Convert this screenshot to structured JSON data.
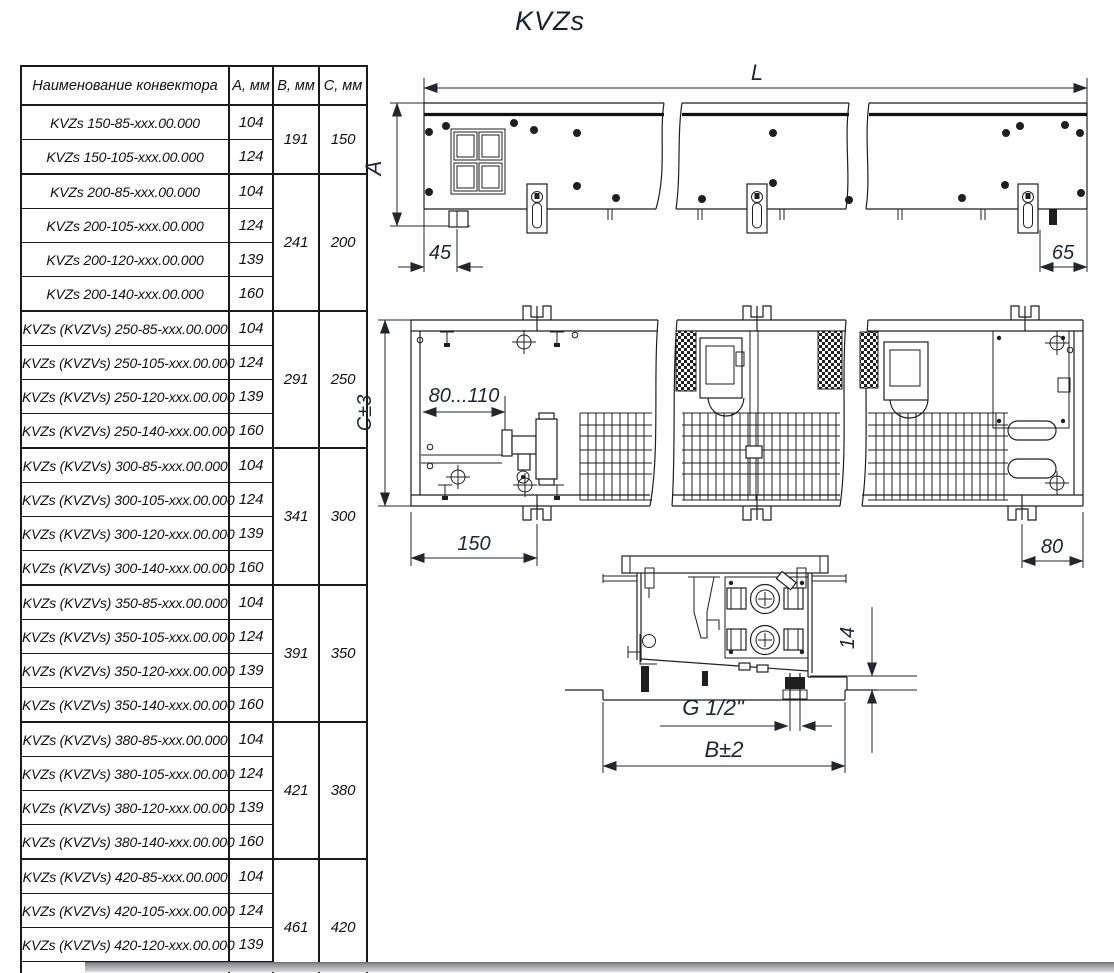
{
  "title": "KVZs",
  "table": {
    "headers": [
      "Наименование конвектора",
      "А, мм",
      "В, мм",
      "С, мм"
    ],
    "groups": [
      {
        "b": "191",
        "c": "150",
        "rows": [
          [
            "KVZs 150-85-xxx.00.000",
            "104"
          ],
          [
            "KVZs 150-105-xxx.00.000",
            "124"
          ]
        ]
      },
      {
        "b": "241",
        "c": "200",
        "rows": [
          [
            "KVZs 200-85-xxx.00.000",
            "104"
          ],
          [
            "KVZs 200-105-xxx.00.000",
            "124"
          ],
          [
            "KVZs 200-120-xxx.00.000",
            "139"
          ],
          [
            "KVZs 200-140-xxx.00.000",
            "160"
          ]
        ]
      },
      {
        "b": "291",
        "c": "250",
        "rows": [
          [
            "KVZs (KVZVs) 250-85-xxx.00.000",
            "104"
          ],
          [
            "KVZs (KVZVs) 250-105-xxx.00.000",
            "124"
          ],
          [
            "KVZs (KVZVs) 250-120-xxx.00.000",
            "139"
          ],
          [
            "KVZs (KVZVs) 250-140-xxx.00.000",
            "160"
          ]
        ]
      },
      {
        "b": "341",
        "c": "300",
        "rows": [
          [
            "KVZs (KVZVs) 300-85-xxx.00.000",
            "104"
          ],
          [
            "KVZs (KVZVs) 300-105-xxx.00.000",
            "124"
          ],
          [
            "KVZs (KVZVs) 300-120-xxx.00.000",
            "139"
          ],
          [
            "KVZs (KVZVs) 300-140-xxx.00.000",
            "160"
          ]
        ]
      },
      {
        "b": "391",
        "c": "350",
        "rows": [
          [
            "KVZs (KVZVs) 350-85-xxx.00.000",
            "104"
          ],
          [
            "KVZs (KVZVs) 350-105-xxx.00.000",
            "124"
          ],
          [
            "KVZs (KVZVs) 350-120-xxx.00.000",
            "139"
          ],
          [
            "KVZs (KVZVs) 350-140-xxx.00.000",
            "160"
          ]
        ]
      },
      {
        "b": "421",
        "c": "380",
        "rows": [
          [
            "KVZs (KVZVs) 380-85-xxx.00.000",
            "104"
          ],
          [
            "KVZs (KVZVs) 380-105-xxx.00.000",
            "124"
          ],
          [
            "KVZs (KVZVs) 380-120-xxx.00.000",
            "139"
          ],
          [
            "KVZs (KVZVs) 380-140-xxx.00.000",
            "160"
          ]
        ]
      },
      {
        "b": "461",
        "c": "420",
        "rows": [
          [
            "KVZs (KVZVs) 420-85-xxx.00.000",
            "104"
          ],
          [
            "KVZs (KVZVs) 420-105-xxx.00.000",
            "124"
          ],
          [
            "KVZs (KVZVs) 420-120-xxx.00.000",
            "139"
          ],
          [
            "KVZs (KVZVs) 420-140-xxx.00.000",
            "160"
          ]
        ]
      }
    ]
  },
  "drawings": {
    "top_view": {
      "dim_length": "L",
      "dim_height": "A",
      "dim_left_offset": "45",
      "dim_right_offset": "65"
    },
    "plan_view": {
      "dim_depth": "С±3",
      "dim_valve_range": "80...110",
      "dim_left": "150",
      "dim_right": "80"
    },
    "side_view": {
      "dim_gap": "14",
      "dim_thread": "G 1/2\"",
      "dim_width": "B±2"
    }
  }
}
